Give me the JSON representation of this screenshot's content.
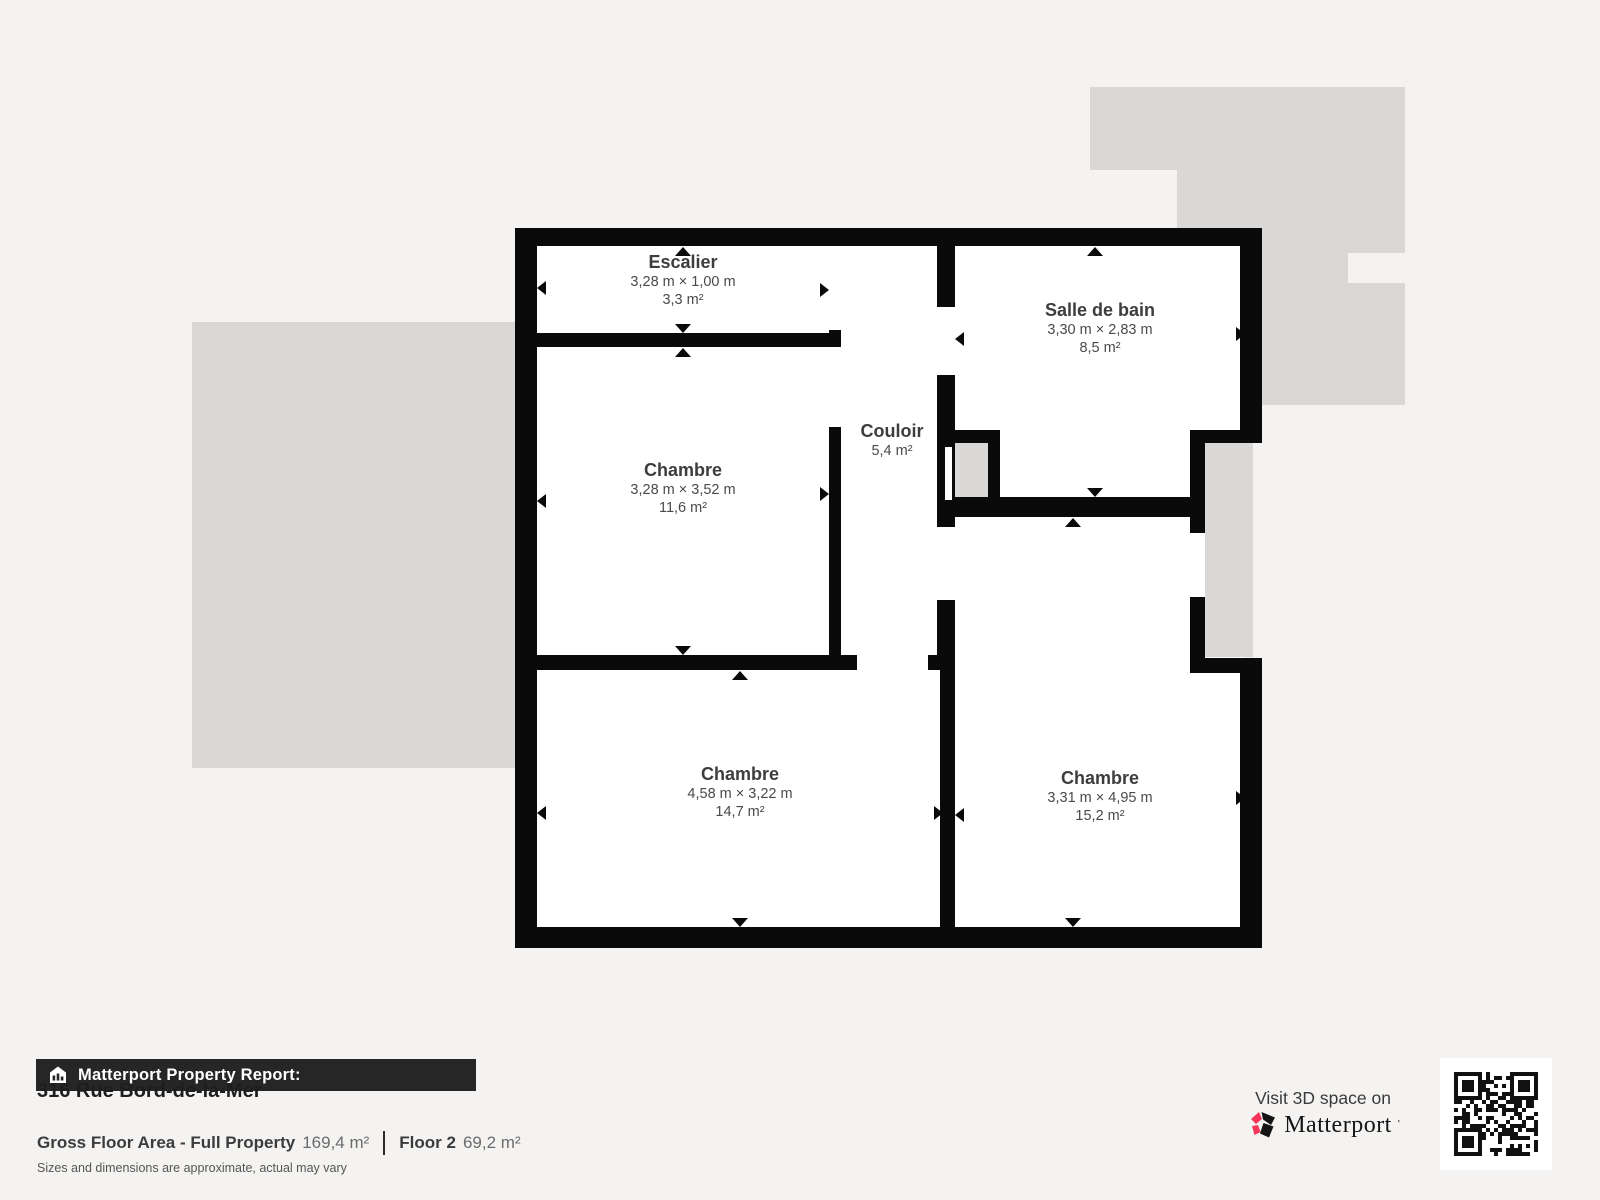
{
  "page": {
    "background": "#f4f3f1"
  },
  "floorplan": {
    "wall_color": "#0a0a0a",
    "room_fill": "#ffffff",
    "adjacent_floor_fill": "#d9d8d6",
    "rooms": [
      {
        "id": "escalier",
        "name": "Escalier",
        "dims": "3,28 m × 1,00 m",
        "area": "3,3 m²"
      },
      {
        "id": "chambre-nw",
        "name": "Chambre",
        "dims": "3,28 m × 3,52 m",
        "area": "11,6 m²"
      },
      {
        "id": "couloir",
        "name": "Couloir",
        "dims": "",
        "area": "5,4 m²"
      },
      {
        "id": "salle-de-bain",
        "name": "Salle de bain",
        "dims": "3,30 m × 2,83 m",
        "area": "8,5 m²"
      },
      {
        "id": "chambre-sw",
        "name": "Chambre",
        "dims": "4,58 m × 3,22 m",
        "area": "14,7 m²"
      },
      {
        "id": "chambre-se",
        "name": "Chambre",
        "dims": "3,31 m × 4,95 m",
        "area": "15,2 m²"
      }
    ]
  },
  "report": {
    "banner": "Matterport Property Report:",
    "address": "316 Rue Bord-de-la-Mer",
    "gross_label": "Gross Floor Area - Full Property",
    "gross_value": "169,4 m²",
    "floor_label": "Floor 2",
    "floor_value": "69,2 m²",
    "disclaimer": "Sizes and dimensions are approximate, actual may vary"
  },
  "cta": {
    "line": "Visit 3D space on",
    "brand": "Matterport",
    "brand_accent": "#f43458"
  }
}
